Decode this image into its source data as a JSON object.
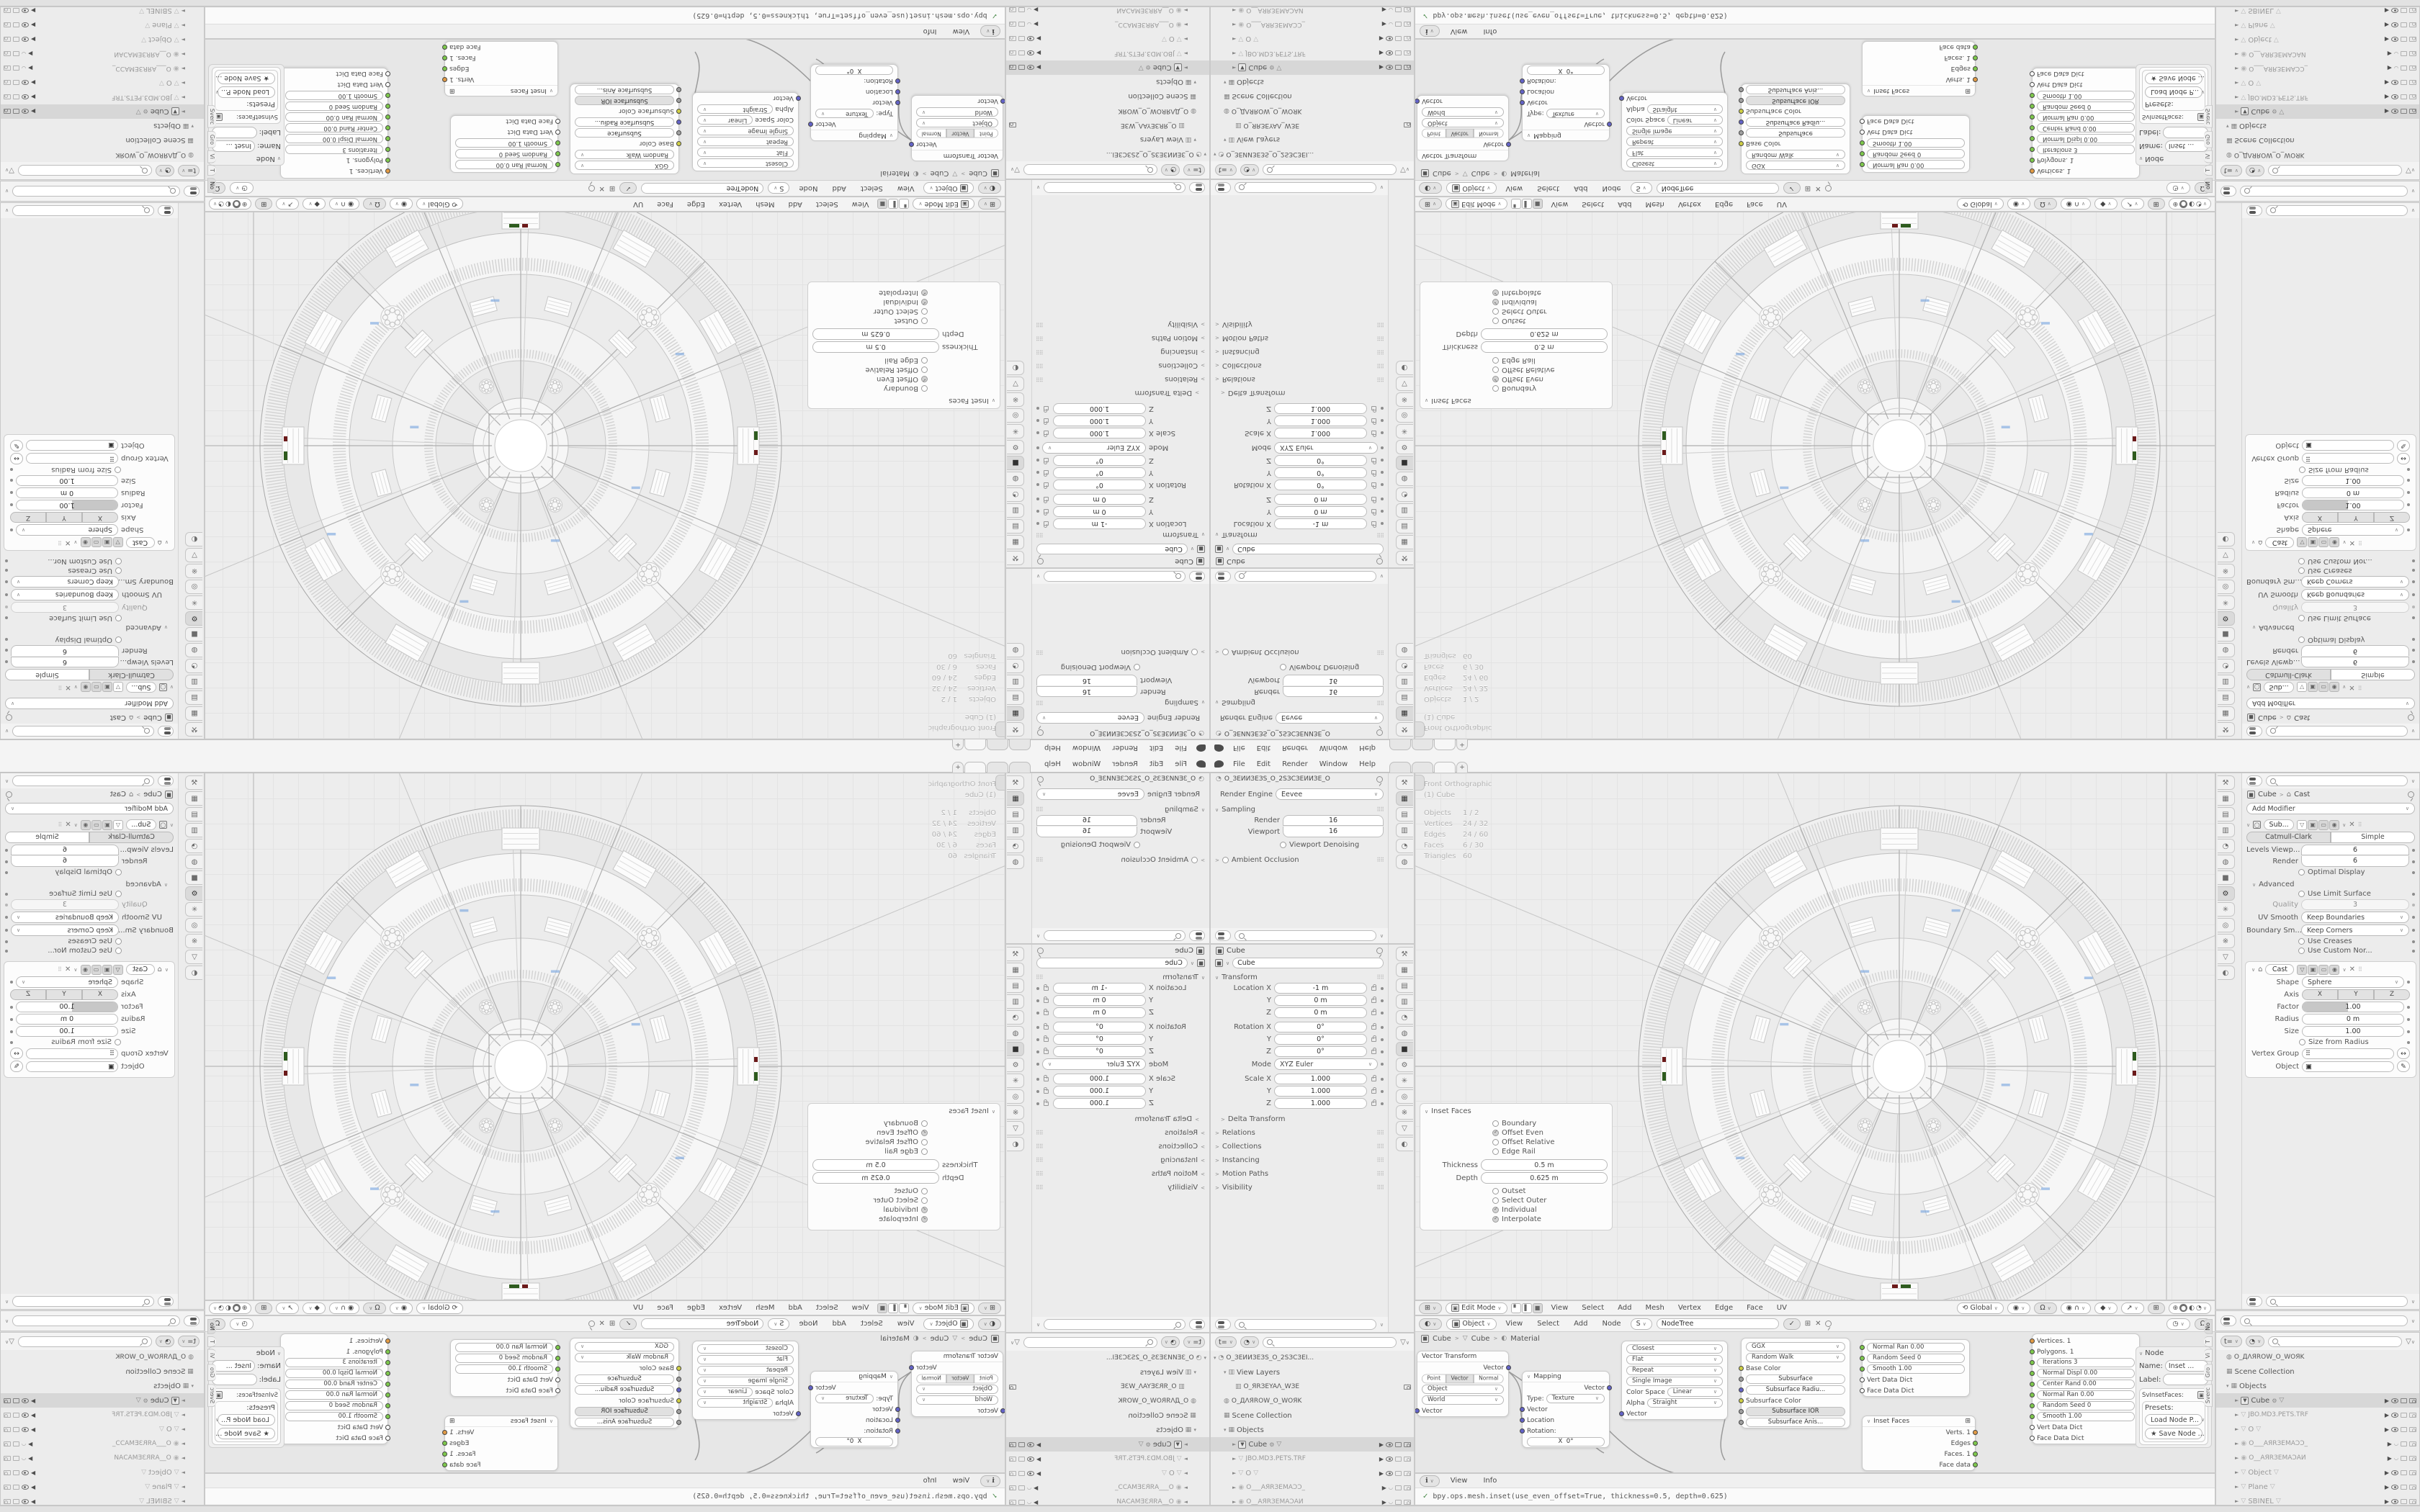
{
  "topbar": {
    "menus": [
      "File",
      "Edit",
      "Render",
      "Window",
      "Help"
    ]
  },
  "props_render": {
    "scene_name": "O_ЗЕИИЗЕЗS_O_2SЗСЗЕИИЗЕ_O",
    "engine_label": "Render Engine",
    "engine": "Eevee",
    "sampling": "Sampling",
    "render_label": "Render",
    "render": "16",
    "viewport_label": "Viewport",
    "viewport": "16",
    "denoising": "Viewport Denoising",
    "ao": "Ambient Occlusion"
  },
  "props_object": {
    "breadcrumb": "Cube",
    "name": "Cube",
    "transform": "Transform",
    "rows": [
      {
        "l": "Location X",
        "v": "-1 m"
      },
      {
        "l": "Y",
        "v": "0 m"
      },
      {
        "l": "Z",
        "v": "0 m"
      },
      {
        "l": "Rotation X",
        "v": "0°"
      },
      {
        "l": "Y",
        "v": "0°"
      },
      {
        "l": "Z",
        "v": "0°"
      },
      {
        "l": "Mode",
        "v": "XYZ Euler"
      },
      {
        "l": "Scale X",
        "v": "1.000"
      },
      {
        "l": "Y",
        "v": "1.000"
      },
      {
        "l": "Z",
        "v": "1.000"
      }
    ],
    "sections": [
      "Delta Transform",
      "Relations",
      "Collections",
      "Instancing",
      "Motion Paths",
      "Visibility"
    ]
  },
  "props_modifier": {
    "crumb_object": "Cube",
    "crumb_mod": "Cast",
    "add_modifier": "Add Modifier",
    "subdiv": {
      "name": "Sub...",
      "tab_a": "Catmull-Clark",
      "tab_b": "Simple",
      "levels_label": "Levels Viewp...",
      "levels": "6",
      "render_label": "Render",
      "render": "6",
      "optimal": "Optimal Display",
      "advanced": "Advanced",
      "limit": "Use Limit Surface",
      "quality_label": "Quality",
      "quality": "3",
      "uv_label": "UV Smooth",
      "uv": "Keep Boundaries",
      "boundary_label": "Boundary Sm...",
      "boundary": "Keep Corners",
      "creases": "Use Creases",
      "normals": "Use Custom Nor..."
    },
    "cast": {
      "name": "Cast",
      "shape_label": "Shape",
      "shape": "Sphere",
      "axis_label": "Axis",
      "ax": "X",
      "ay": "Y",
      "az": "Z",
      "factor_label": "Factor",
      "factor": "1.00",
      "radius_label": "Radius",
      "radius": "0 m",
      "size_label": "Size",
      "size": "1.00",
      "sfr": "Size from Radius",
      "vg_label": "Vertex Group",
      "object_label": "Object"
    }
  },
  "viewport": {
    "view": "Front Orthographic",
    "active": "(1) Cube",
    "stats": [
      {
        "l": "Objects",
        "v": "1 / 2"
      },
      {
        "l": "Vertices",
        "v": "24 / 32"
      },
      {
        "l": "Edges",
        "v": "24 / 60"
      },
      {
        "l": "Faces",
        "v": "6 / 30"
      },
      {
        "l": "Triangles",
        "v": "60"
      }
    ],
    "mode": "Edit Mode",
    "menus": [
      "View",
      "Select",
      "Add",
      "Mesh",
      "Vertex",
      "Edge",
      "Face",
      "UV"
    ],
    "orientation": "Global"
  },
  "inset": {
    "title": "Inset Faces",
    "o1": "Boundary",
    "o2": "Offset Even",
    "o3": "Offset Relative",
    "o4": "Edge Rail",
    "thickness_label": "Thickness",
    "thickness": "0.5 m",
    "depth_label": "Depth",
    "depth": "0.625 m",
    "o5": "Outset",
    "o6": "Select Outer",
    "o7": "Individual",
    "o8": "Interpolate"
  },
  "node_editor": {
    "menus": [
      "View",
      "Select",
      "Add",
      "Node"
    ],
    "tree_name": "NodeTree",
    "crumbs": {
      "a": "Cube",
      "b": "Cube",
      "c": "Material"
    },
    "vt": {
      "title": "Vector Transform",
      "out": "Vector",
      "m1": "Point",
      "m2": "Vector",
      "m3": "Normal",
      "f1": "Object",
      "f2": "World",
      "in": "Vector"
    },
    "mapping": {
      "title": "Mapping",
      "out": "Vector",
      "type_label": "Type:",
      "type": "Texture",
      "in1": "Vector",
      "in2": "Location",
      "in3": "Rotation:",
      "x": "X",
      "xv": "0°"
    },
    "imgtex": {
      "f1": "Closest",
      "f2": "Flat",
      "f3": "Repeat",
      "f4": "Single Image",
      "cs_label": "Color Space",
      "cs": "Linear",
      "alpha_label": "Alpha",
      "alpha": "Straight",
      "in": "Vector"
    },
    "bsdf": {
      "f1": "GGX",
      "f2": "Random Walk",
      "s1": "Base Color",
      "s2": "Subsurface",
      "s3": "Subsurface Radiu...",
      "s4": "Subsurface Color",
      "s5": "Subsurface IOR",
      "s6": "Subsurface Anis..."
    },
    "sv1": {
      "r1": "Normal Ran  0.00",
      "r2": "Random Seed  0",
      "r3": "Smooth  1.00",
      "d1": "Vert Data Dict",
      "d2": "Face Data Dict"
    },
    "inset_node": {
      "title": "Inset Faces",
      "o1": "Verts. 1",
      "o2": "Edges",
      "o3": "Faces. 1",
      "o4": "Face data"
    },
    "sv2": {
      "o1": "Vertices. 1",
      "o2": "Polygons. 1",
      "f1": "Iterations  3",
      "f2": "Normal Displ  0.00",
      "f3": "Center Rand  0.00",
      "f4": "Normal Ran  0.00",
      "f5": "Random Seed  0",
      "f6": "Smooth  1.00",
      "d1": "Vert Data Dict",
      "d2": "Face Data Dict"
    },
    "npanel": {
      "title": "Node",
      "name_label": "Name:",
      "name": "Inset ...",
      "label_label": "Label:",
      "type_name": "SvInsetFaces:",
      "presets": "Presets:",
      "load": "Load Node P...",
      "save": "Save Node ...",
      "t1": "No",
      "t2": "T",
      "t3": "Vi",
      "t4": "Gro",
      "t5": "Sverc"
    }
  },
  "info": {
    "m1": "View",
    "m2": "Info",
    "line": "bpy.ops.mesh.inset(use_even_offset=True,  thickness=0.5,  depth=0.625)"
  },
  "outliner": {
    "scene": "O_ЗЕИИЗЕЗS_O_2SЗСЗЕI...",
    "view_layers": "View Layers",
    "view_layer": "O_ЯRЗEYAΛ_WЗЕ",
    "world": "O_ДΛЯROW_O_WOЯK",
    "collection": "Scene Collection",
    "objects": "Objects",
    "items": [
      "Cube",
      "JBO.MD3.PETS.TRF",
      "O",
      "O___AЯRЗEMAƆƆ_",
      "O__AЯRЗEMAƆAИ",
      "Object",
      "Plane",
      "SBINEL"
    ]
  },
  "colors": {
    "socket_green": "#7ec94c",
    "socket_orange": "#e29b45",
    "socket_blue": "#6363c7",
    "socket_yellow": "#cfcf44",
    "accent_green": "#2e5b1e",
    "accent_red": "#6b1a1a",
    "accent_blue": "#7ea9e0"
  }
}
